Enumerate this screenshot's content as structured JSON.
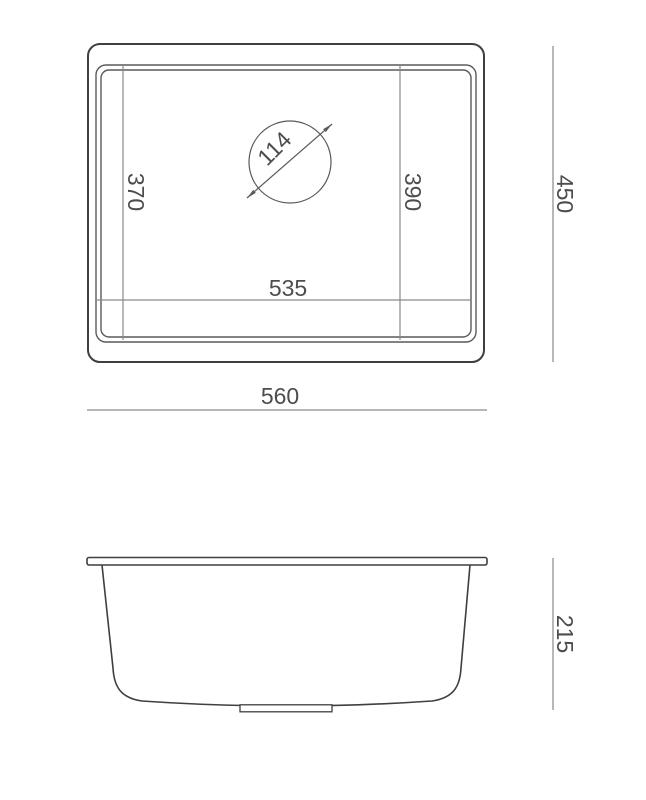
{
  "drawing": {
    "colors": {
      "line": "#3f3f3f",
      "line_mid": "#5a5a5a",
      "line_dim": "#8a8a8a",
      "text": "#4d4d4d",
      "background": "#ffffff"
    },
    "top_view": {
      "overall_width_label": "560",
      "overall_depth_label": "450",
      "bowl_width_label": "535",
      "left_depth_label": "370",
      "right_depth_label": "390",
      "drain_diameter_label": "114"
    },
    "side_view": {
      "height_label": "215"
    }
  }
}
